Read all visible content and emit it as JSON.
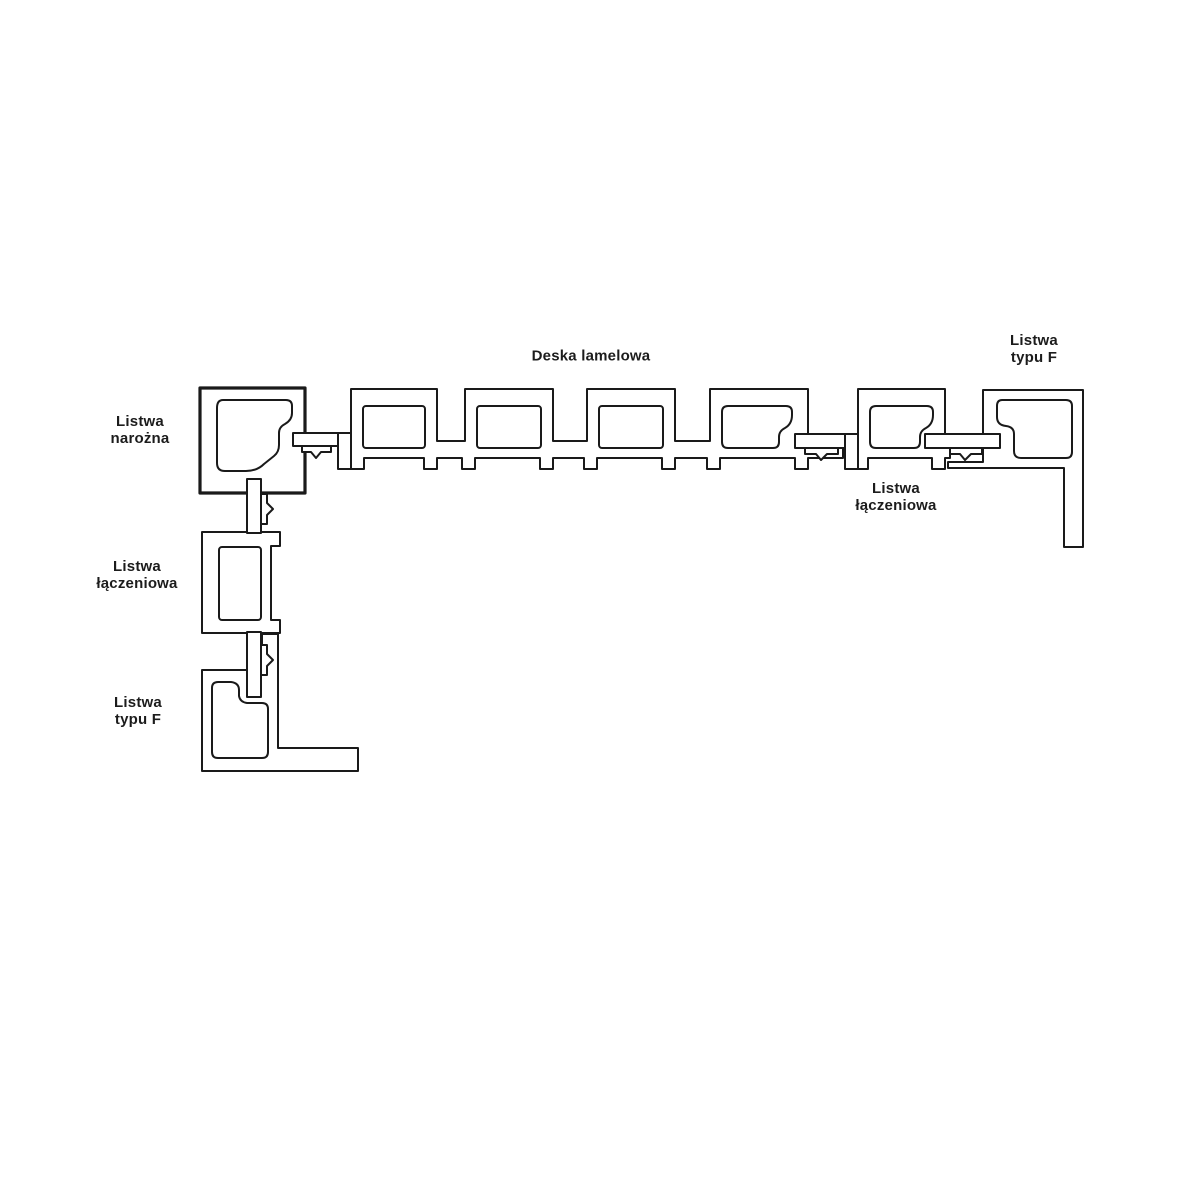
{
  "diagram": {
    "title": "Deska lamelowa",
    "labels": {
      "deska_lamelowa": "Deska lamelowa",
      "listwa_typu_f_right": {
        "line1": "Listwa",
        "line2": "typu F"
      },
      "listwa_narozna": {
        "line1": "Listwa",
        "line2": "narożna"
      },
      "listwa_laczeniowa_right": {
        "line1": "Listwa",
        "line2": "łączeniowa"
      },
      "listwa_laczeniowa_left": {
        "line1": "Listwa",
        "line2": "łączeniowa"
      },
      "listwa_typu_f_left": {
        "line1": "Listwa",
        "line2": "typu F"
      }
    },
    "colors": {
      "line": "#1a1a1a",
      "background": "#ffffff",
      "text": "#1c1c1c"
    }
  }
}
